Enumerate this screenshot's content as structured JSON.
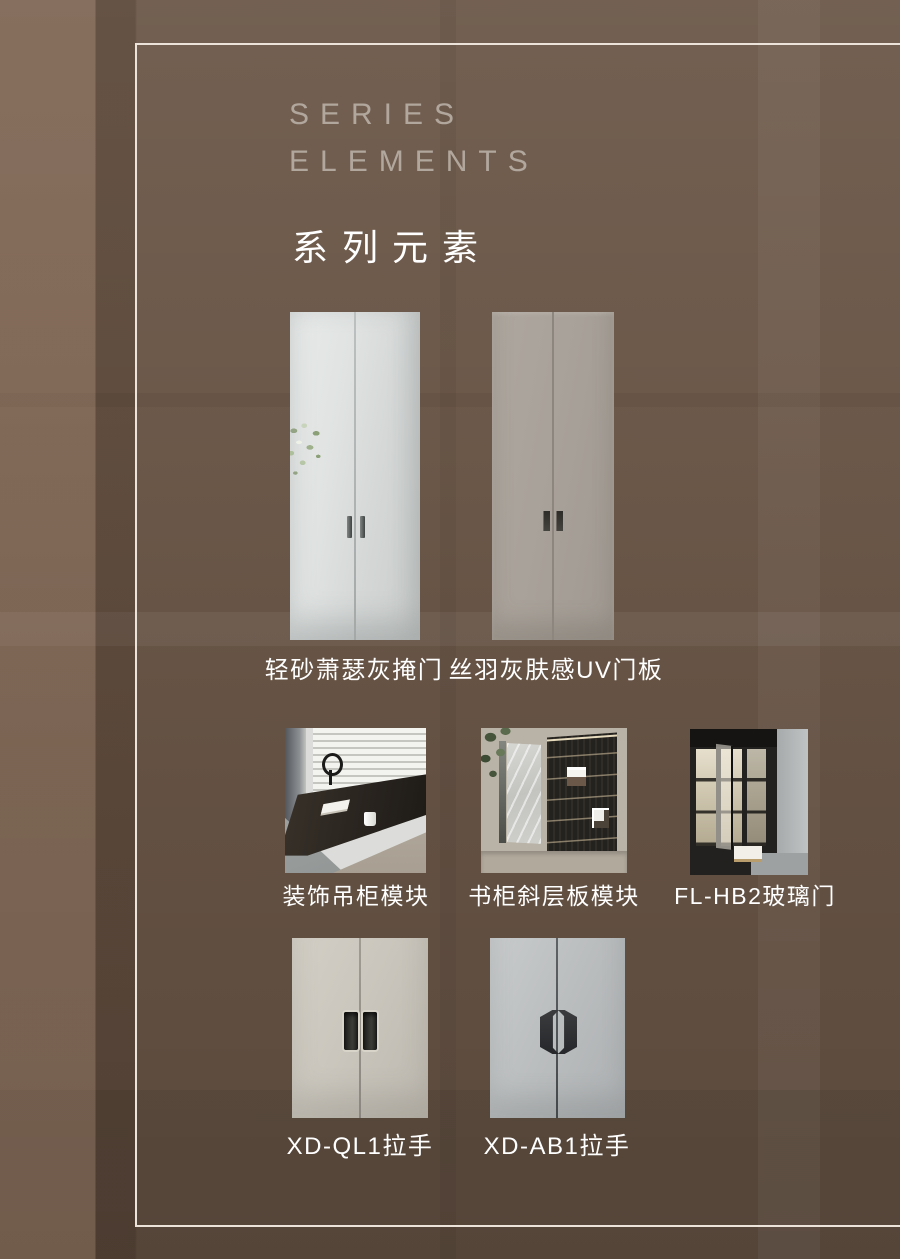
{
  "page": {
    "colors": {
      "background": "#6a5647",
      "frame_line": "#ece4da",
      "title_english": "#b2a79d",
      "title_chinese": "#ffffff",
      "caption_text": "#ffffff"
    }
  },
  "header": {
    "title_en_line1": "SERIES",
    "title_en_line2": "ELEMENTS",
    "title_zh": "系列元素"
  },
  "products": [
    {
      "id": "door-light-sand-gray",
      "label": "轻砂萧瑟灰掩门"
    },
    {
      "id": "door-silk-feather-gray-uv",
      "label": "丝羽灰肤感UV门板"
    },
    {
      "id": "decor-hanging-cabinet",
      "label": "装饰吊柜模块"
    },
    {
      "id": "bookcase-slanted-shelf",
      "label": "书柜斜层板模块"
    },
    {
      "id": "glass-door-fl-hb2",
      "label": "FL-HB2玻璃门"
    },
    {
      "id": "handle-xd-ql1",
      "label": "XD-QL1拉手"
    },
    {
      "id": "handle-xd-ab1",
      "label": "XD-AB1拉手"
    }
  ]
}
